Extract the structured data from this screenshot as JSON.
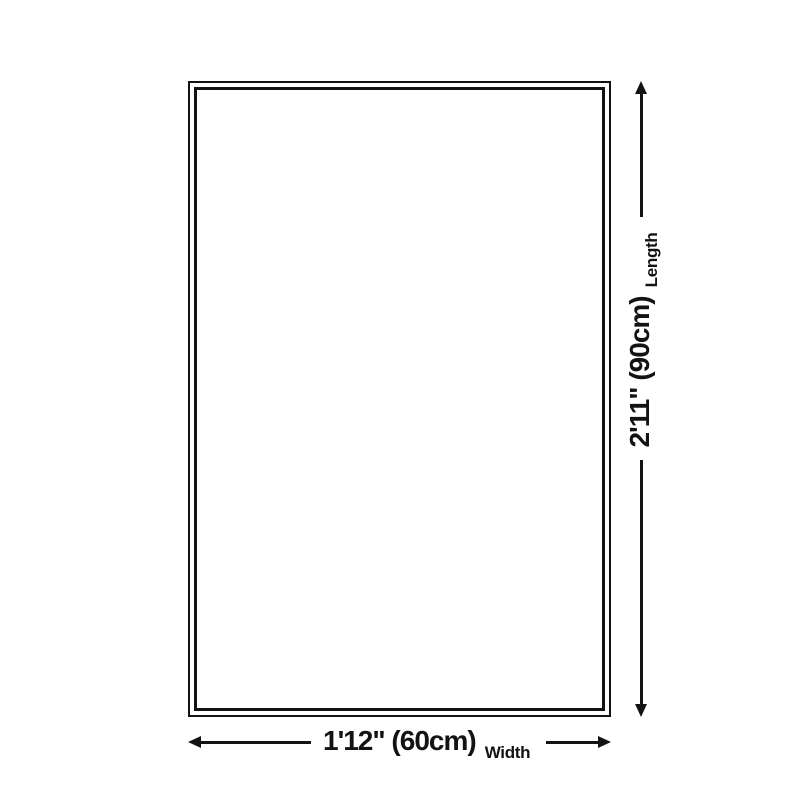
{
  "diagram": {
    "type": "product-size-diagram",
    "background_color": "#ffffff",
    "line_color": "#131313",
    "shape": "rectangle-double-border",
    "dimensions": {
      "width": {
        "value": "1'12\" (60cm)",
        "caption": "Width"
      },
      "length": {
        "value": "2'11\" (90cm)",
        "caption": "Length"
      }
    }
  }
}
